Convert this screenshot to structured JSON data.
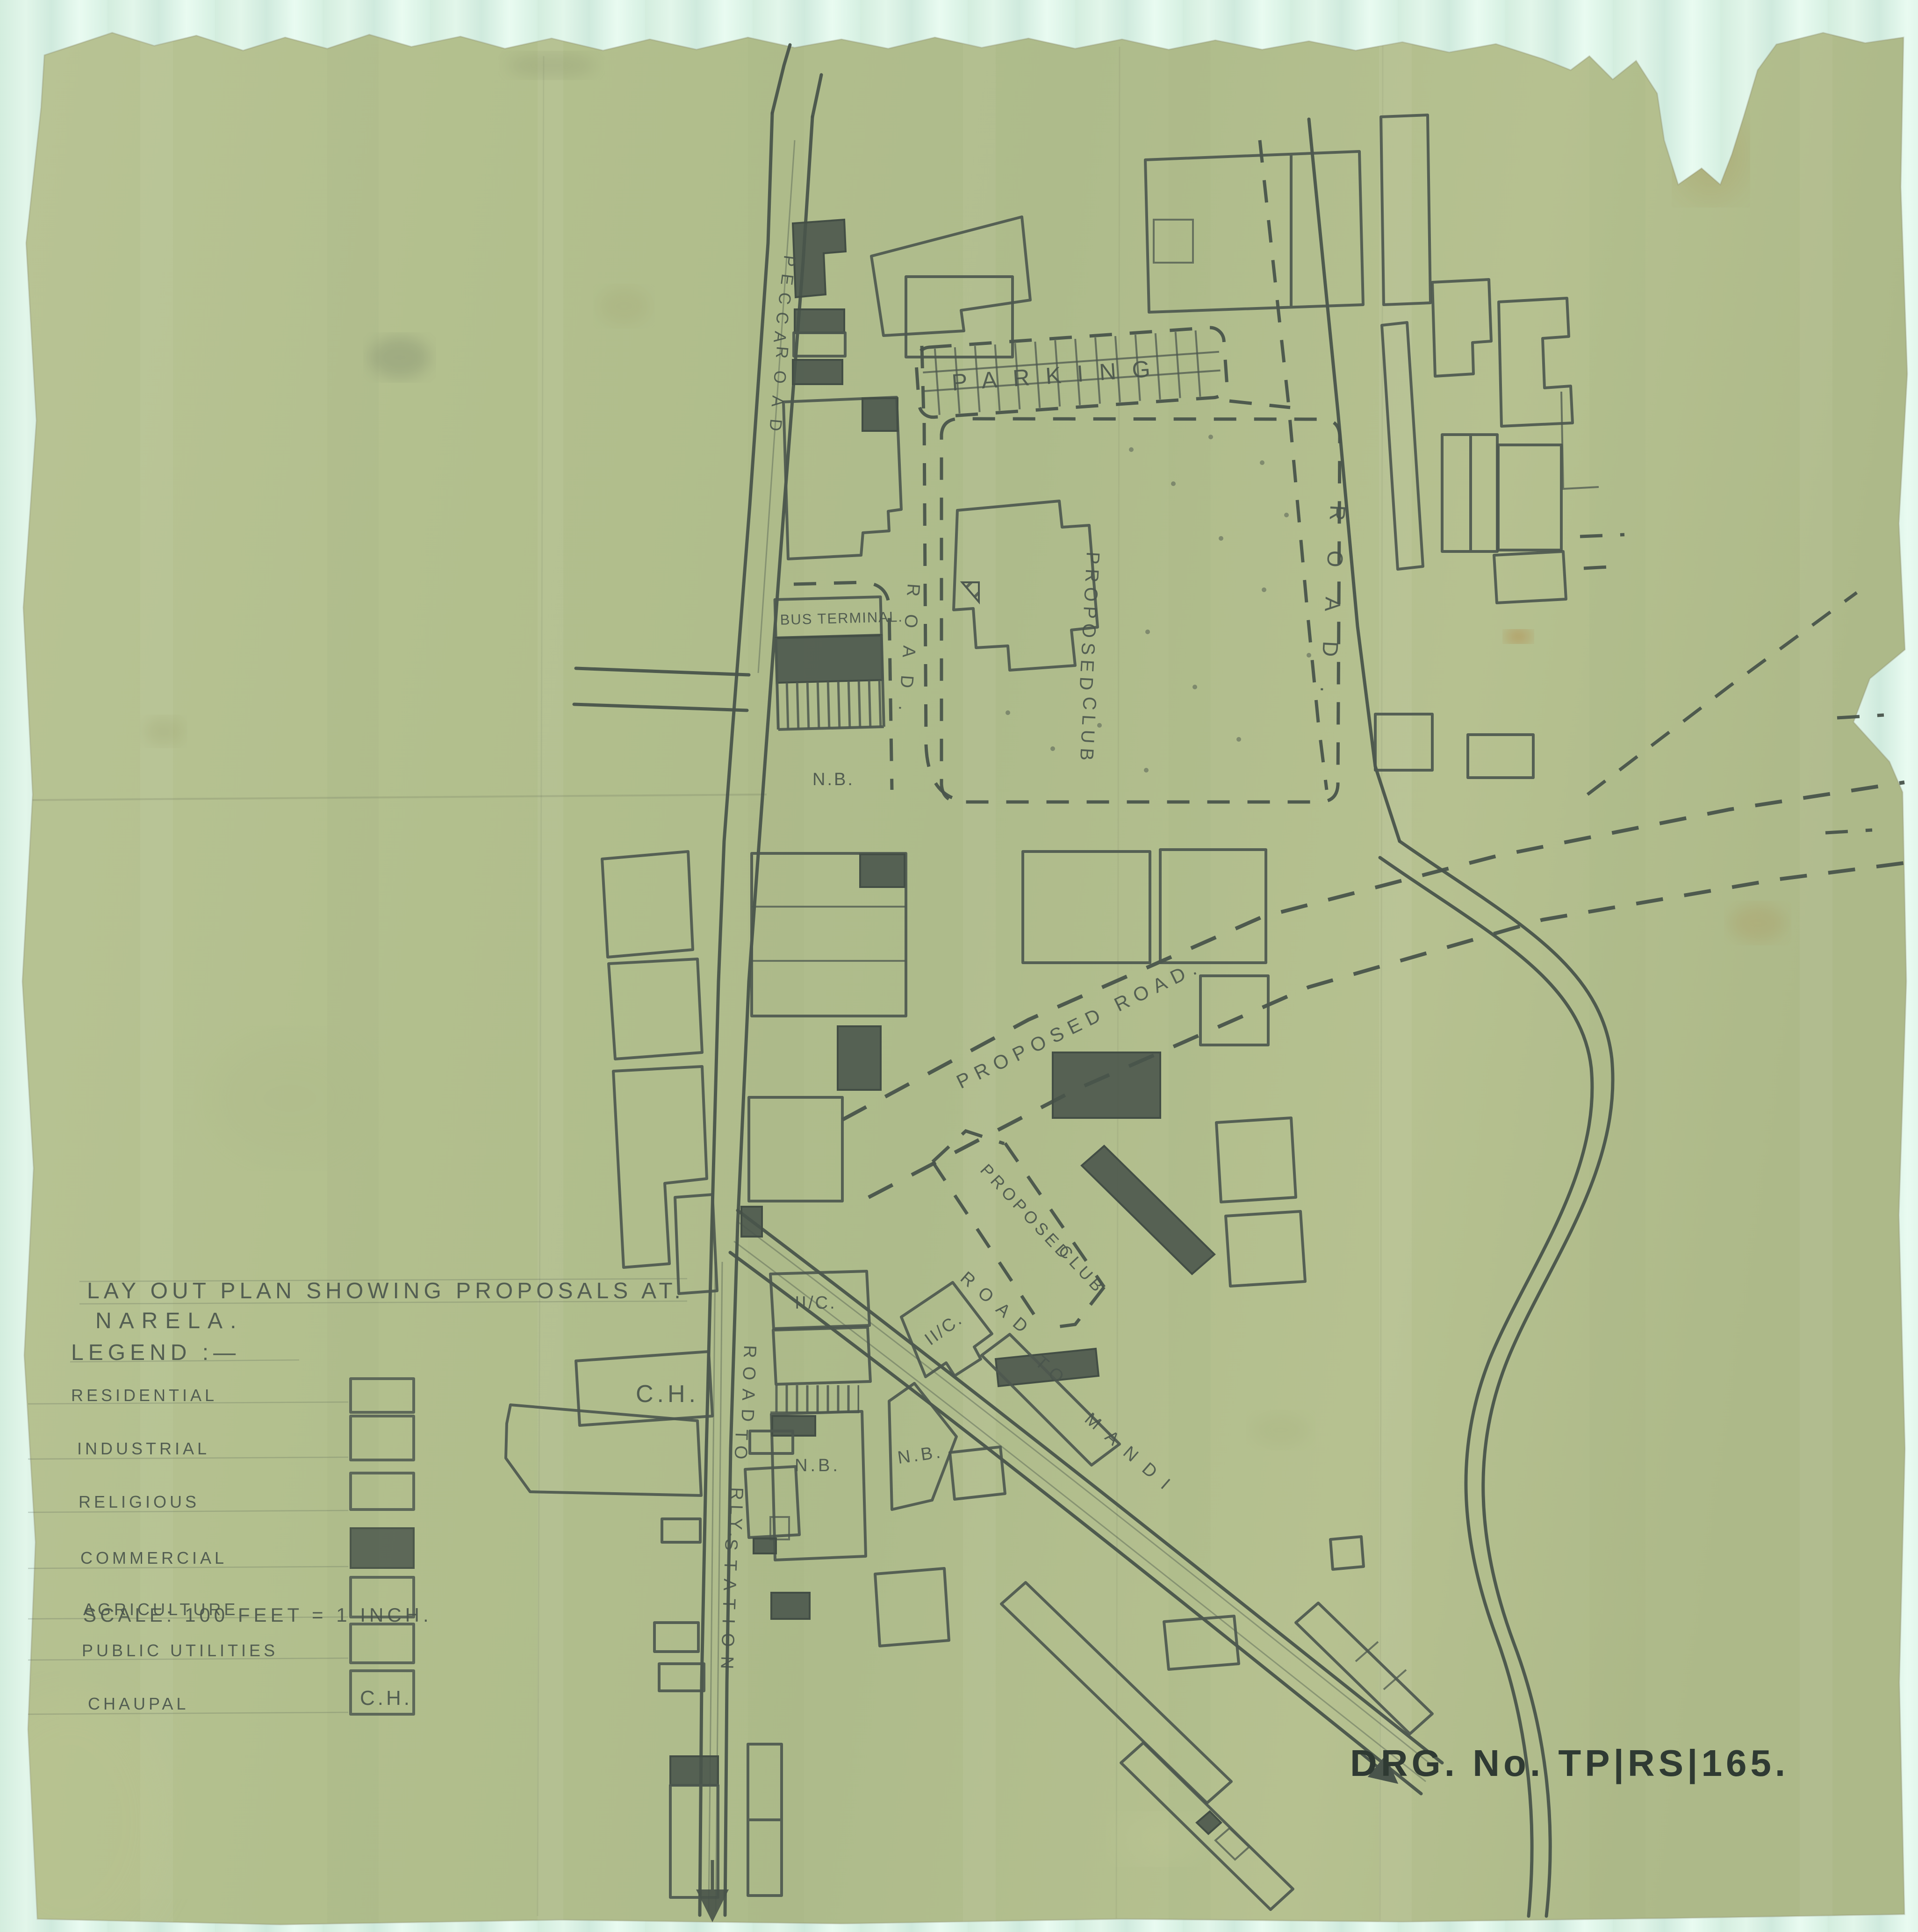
{
  "colors": {
    "scanner_background": "#d9f0e3",
    "paper": "#b4c08e",
    "pencil_ink": "#4b564d",
    "dark_ink": "#2f3a33"
  },
  "title_block": {
    "title_line1": "LAY OUT PLAN SHOWING PROPOSALS AT.",
    "title_line2": "NARELA.",
    "legend_heading": "LEGEND :—"
  },
  "legend": {
    "items": [
      {
        "label": "RESIDENTIAL",
        "swatch": "plain"
      },
      {
        "label": "INDUSTRIAL",
        "swatch": "vertical-stripes"
      },
      {
        "label": "RELIGIOUS",
        "swatch": "grid"
      },
      {
        "label": "COMMERCIAL",
        "swatch": "solid"
      },
      {
        "label": "AGRICULTURE",
        "swatch": "diagonal-hatch"
      },
      {
        "label": "PUBLIC UTILITIES",
        "swatch": "diagonal-hatch"
      },
      {
        "label": "CHAUPAL",
        "swatch": "ch-box"
      }
    ],
    "chaupal_swatch_text": "C.H."
  },
  "scale_note": "SCALE: 100 FEET = 1 INCH.",
  "drawing_number": "DRG. No. TP|RS|165.",
  "map_labels": {
    "parking": "PARKING",
    "bus_terminal": "BUS TERMINAL.",
    "proposed_club_word1": "PROPOSED",
    "proposed_club_word2": "CLUB",
    "proposed_road": "PROPOSED ROAD.",
    "pecca_road_word1": "PECCA",
    "pecca_road_word2": "ROAD",
    "road_vertical_right": "ROAD.",
    "road_inner": "ROAD.",
    "road_to_mandi_word1": "ROAD",
    "road_to_mandi_word2": "TO",
    "road_to_mandi_word3": "MANDI",
    "road_to_rly_word1": "ROAD",
    "road_to_rly_word2": "TO",
    "road_to_rly_word3": "RLY.",
    "road_to_rly_word4": "STATION",
    "new_building": "N.B.",
    "under_construction": "II/C.",
    "chaupal_abbr": "C.H."
  }
}
